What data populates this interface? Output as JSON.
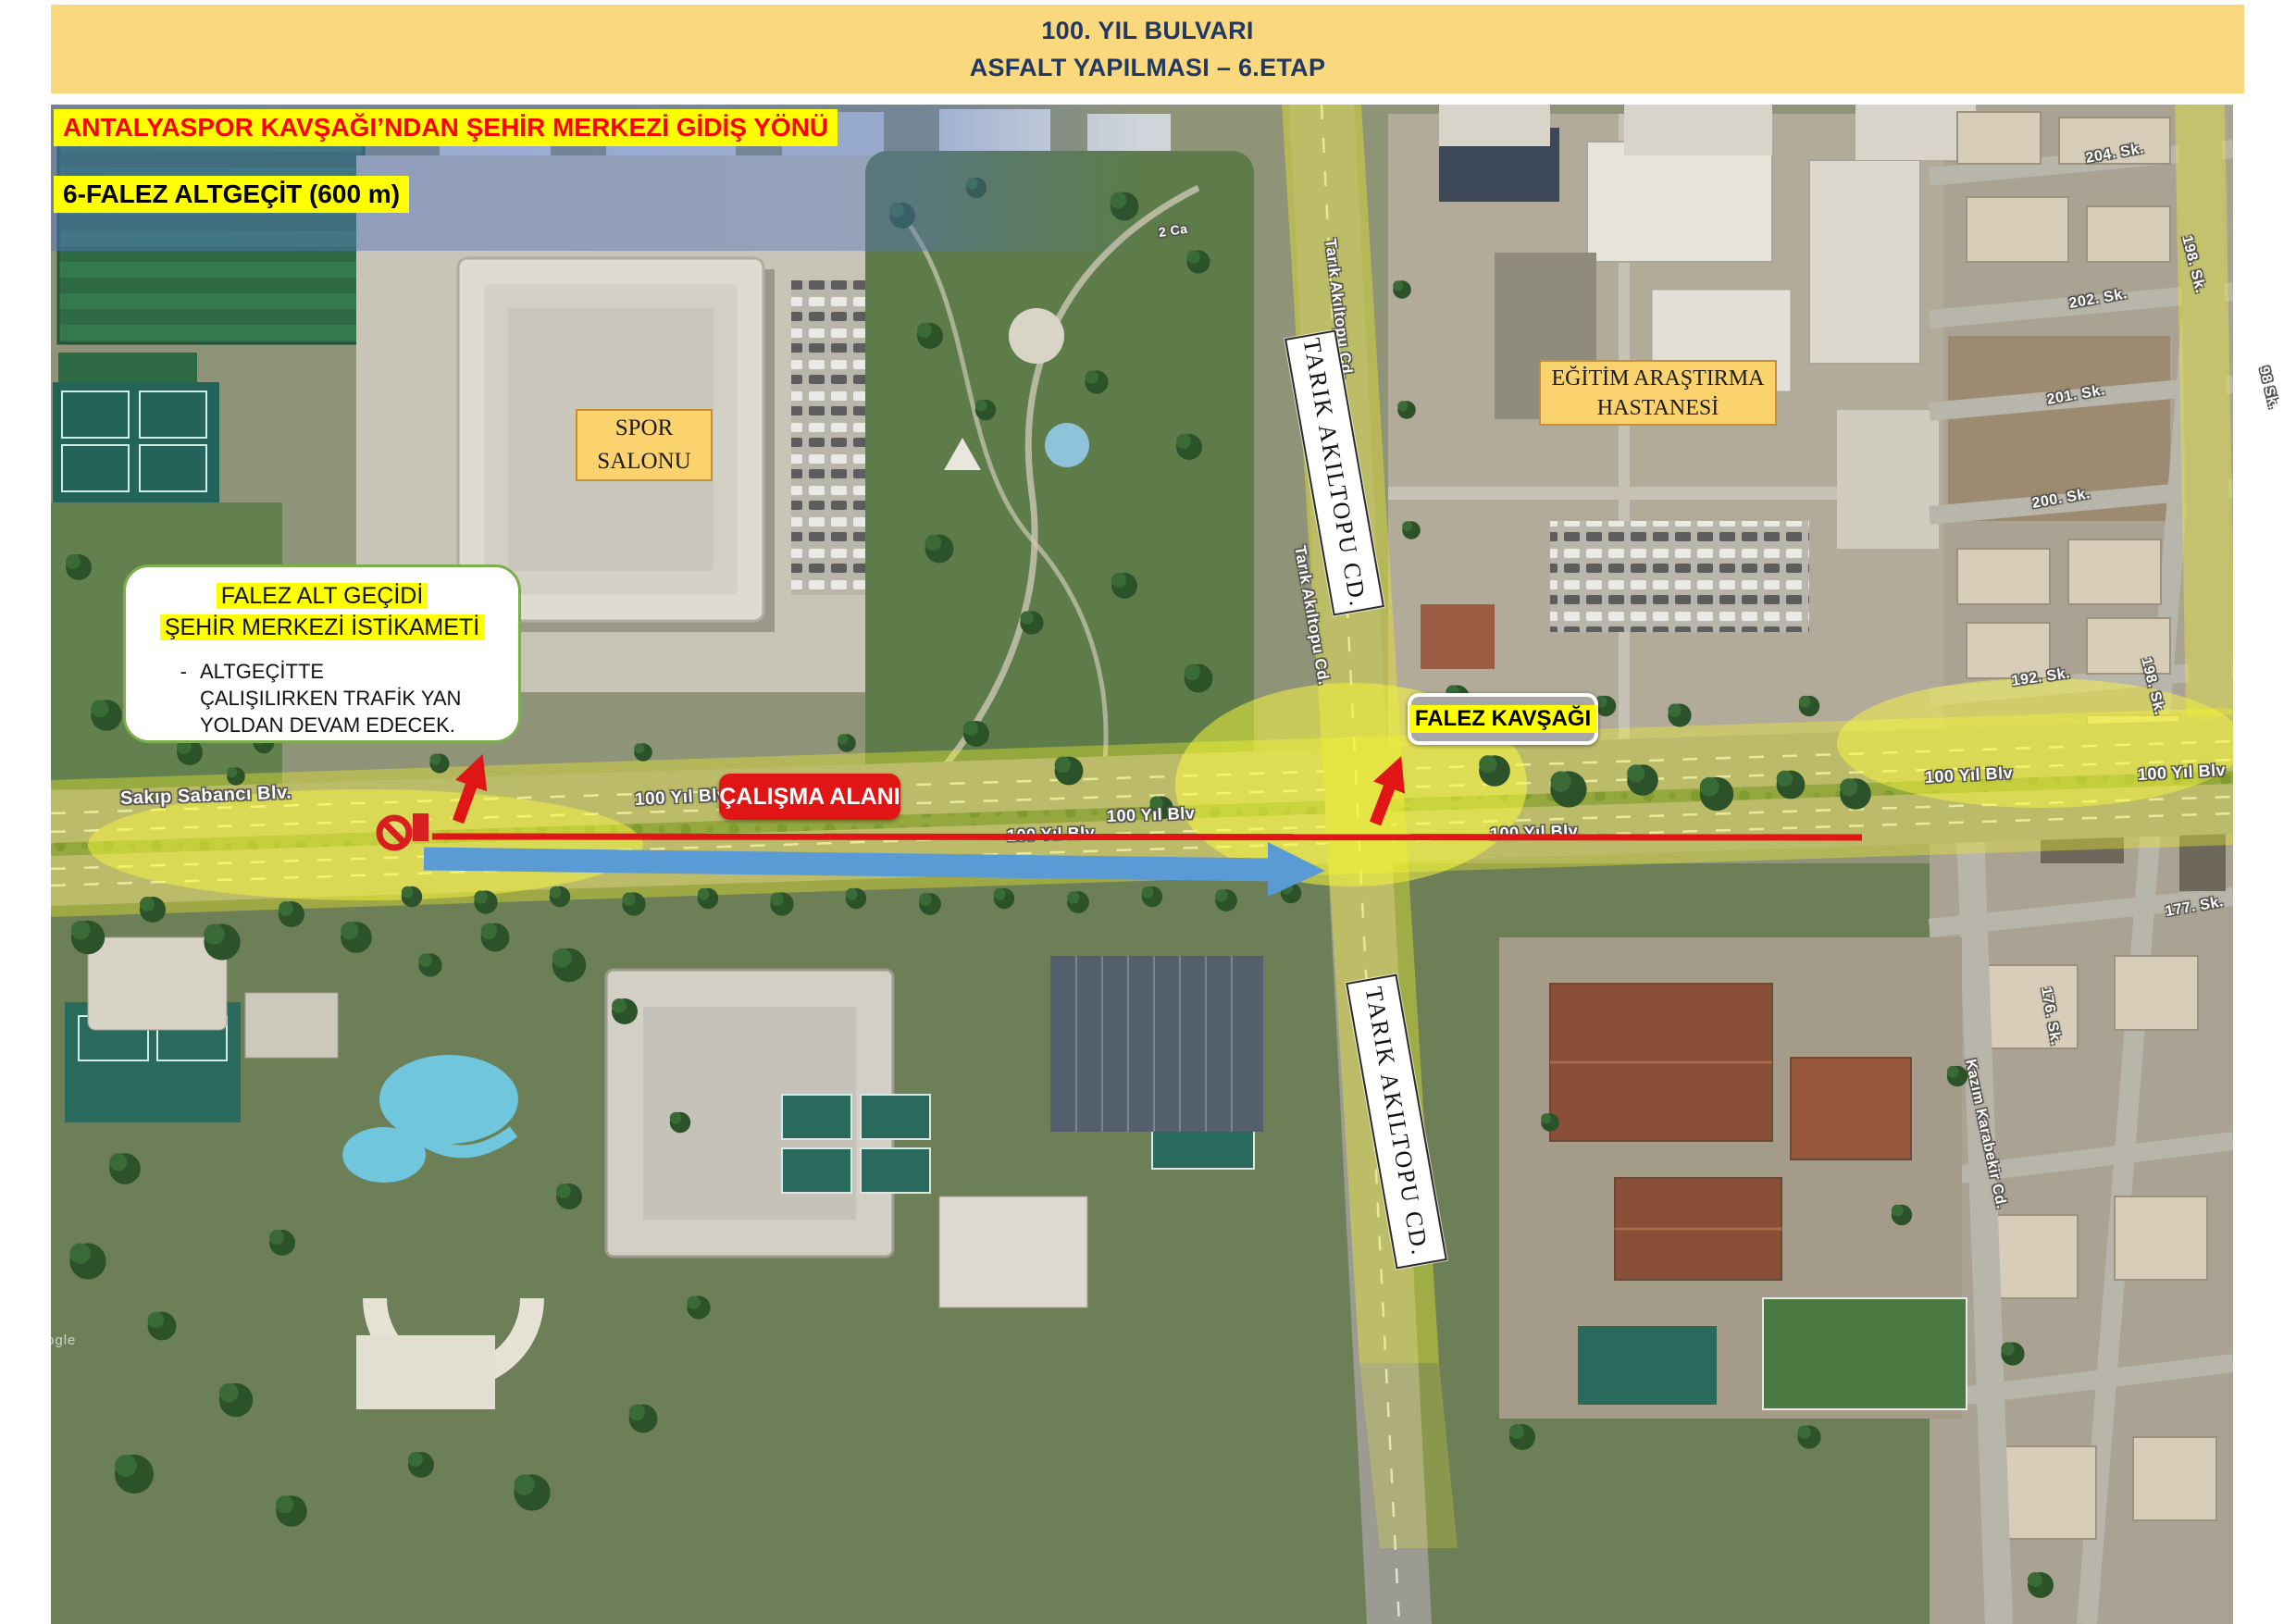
{
  "banner": {
    "title_line1": "100. YIL BULVARI",
    "title_line2": "ASFALT YAPILMASI – 6.ETAP"
  },
  "notes": {
    "direction": "ANTALYASPOR KAVŞAĞI’NDAN ŞEHİR MERKEZİ GİDİŞ YÖNÜ",
    "segment": "6-FALEZ ALTGEÇİT (600 m)"
  },
  "callout": {
    "title_line1": "FALEZ ALT GEÇİDİ",
    "title_line2": "ŞEHİR MERKEZİ İSTİKAMETİ",
    "bullet_marker": "-",
    "bullet_text": "ALTGEÇİTTE ÇALIŞILIRKEN TRAFİK YAN YOLDAN DEVAM EDECEK."
  },
  "map_boxes": {
    "spor_salonu_line1": "SPOR",
    "spor_salonu_line2": "SALONU",
    "hastane_line1": "EĞİTİM ARAŞTIRMA",
    "hastane_line2": "HASTANESİ",
    "falez_kavsagi": "FALEZ KAVŞAĞI",
    "calisma_alani": "ÇALIŞMA ALANI",
    "tarik_top": "TARIK AKILTOPU CD.",
    "tarik_bottom": "TARIK AKILTOPU CD."
  },
  "street_labels": [
    {
      "text": "Sakıp Sabancı Blv."
    },
    {
      "text": "100 Yıl Blv"
    },
    {
      "text": "100 Yıl Blv"
    },
    {
      "text": "100 Yıl Blv"
    },
    {
      "text": "100 Yıl Blv"
    },
    {
      "text": "100 Yıl Blv"
    },
    {
      "text": "100 Yıl Blv"
    },
    {
      "text": "Tarık Akıltopu Cd."
    },
    {
      "text": "Tarık Akıltopu Cd."
    },
    {
      "text": "Tarık Akıltopu Cd."
    },
    {
      "text": "204. Sk."
    },
    {
      "text": "202. Sk."
    },
    {
      "text": "201. Sk."
    },
    {
      "text": "200. Sk."
    },
    {
      "text": "192. Sk."
    },
    {
      "text": "198. Sk."
    },
    {
      "text": "198. Sk."
    },
    {
      "text": "177. Sk."
    },
    {
      "text": "176. Sk."
    },
    {
      "text": "98 Sk."
    },
    {
      "text": "Kazım Karabekir Cd."
    },
    {
      "text": "2 Ca"
    }
  ],
  "watermark": "Google",
  "icons": {
    "no_entry": "no-entry-icon",
    "closure_bar": "closure-bar-icon"
  },
  "colors": {
    "banner_bg": "#FAD87E",
    "banner_text": "#1F3864",
    "note_highlight": "#FFFF00",
    "note_direction_text": "#FF0000",
    "callout_border": "#7CAF4C",
    "place_box_bg": "#FBD36E",
    "place_box_border": "#C9912D",
    "falez_box_bg": "#A8A8A8",
    "calisma_box_bg": "#E01616",
    "route_line_red": "#E01616",
    "detour_arrow_blue": "#5B9BD5",
    "road_highlight_yellow": "#F0F02A"
  }
}
